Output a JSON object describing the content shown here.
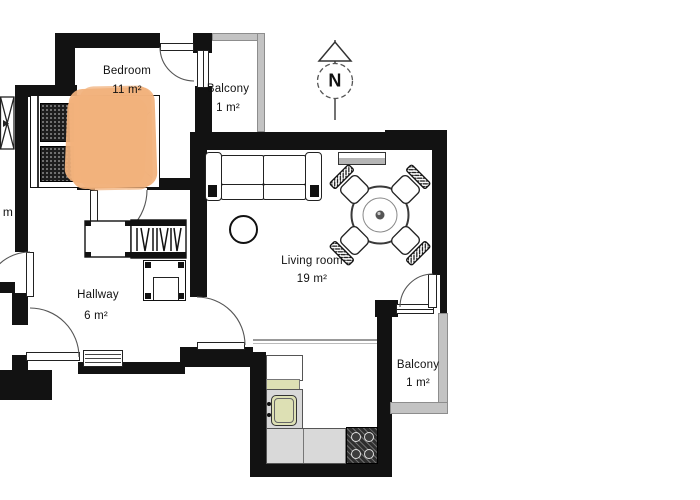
{
  "plan": {
    "title": "Apartment floor plan",
    "rooms": {
      "bedroom": {
        "name": "Bedroom",
        "area": "11 m²"
      },
      "balcony_top": {
        "name": "Balcony",
        "area": "1 m²"
      },
      "living": {
        "name": "Living room",
        "area": "19 m²"
      },
      "hallway": {
        "name": "Hallway",
        "area": "6 m²"
      },
      "balcony_right": {
        "name": "Balcony",
        "area": "1 m²"
      },
      "cutoff_room_fragment": "m"
    },
    "compass": {
      "letter": "N"
    },
    "colors": {
      "wall": "#121212",
      "railing": "#c3c3c3",
      "blanket": "#f2b17c",
      "counter": "#d9d9d9",
      "sink_green": "#dde0b4",
      "stove": "#2e2e2e"
    }
  }
}
